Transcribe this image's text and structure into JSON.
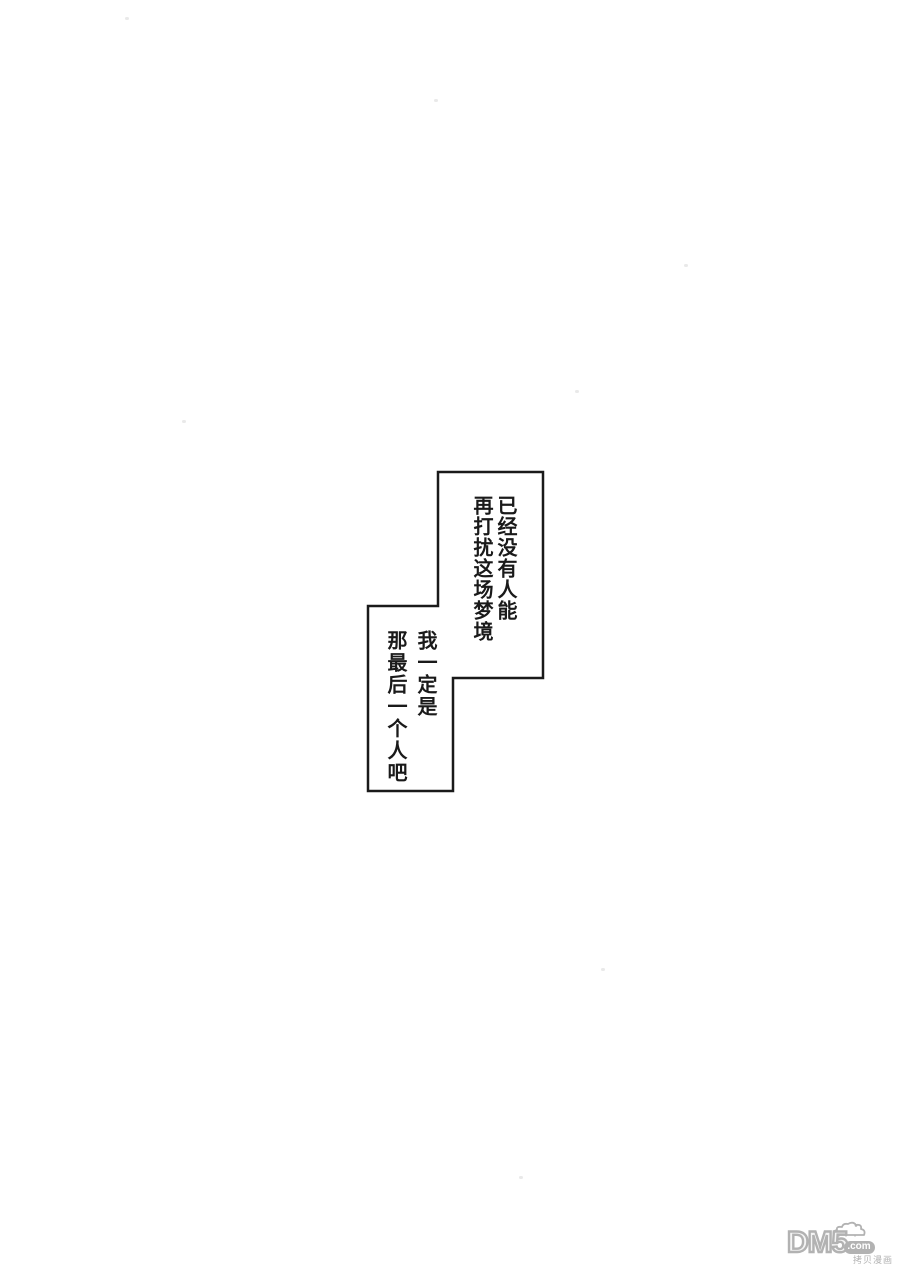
{
  "page": {
    "background": "#ffffff"
  },
  "speech": {
    "ink_color": "#1a1a1a",
    "boxes": [
      {
        "id": "top",
        "lines": [
          "已经没有人能",
          "再打扰这场梦境"
        ]
      },
      {
        "id": "bottom",
        "lines": [
          "我一定是",
          "那最后一个人吧"
        ]
      }
    ]
  },
  "watermark": {
    "logo": "DM5",
    "domain": ".com",
    "tagline": "拷贝漫画",
    "color": "#b2b2b2"
  }
}
